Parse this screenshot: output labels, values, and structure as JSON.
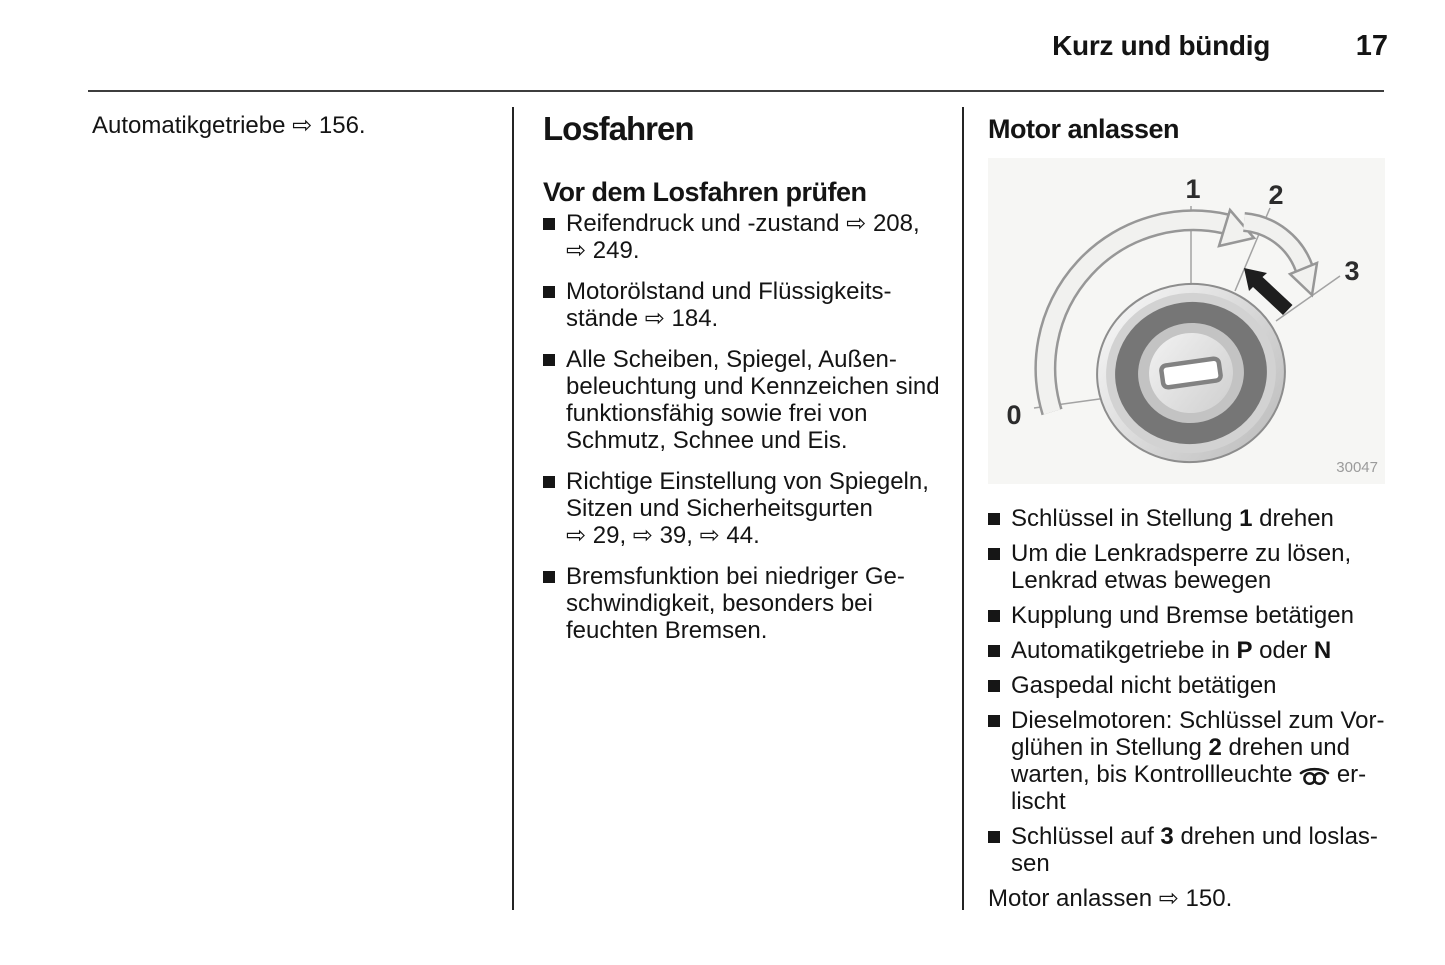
{
  "header": {
    "title": "Kurz und bündig",
    "page_number": "17"
  },
  "left_column": {
    "cross_reference": [
      {
        "text": "Automatikgetriebe ⇨ 156."
      }
    ]
  },
  "middle_column": {
    "heading": "Losfahren",
    "subheading": "Vor dem Losfahren prüfen",
    "bullets": [
      [
        {
          "text": "Reifendruck und -zustand ⇨ 208,"
        },
        {
          "br": true
        },
        {
          "text": "⇨ 249."
        }
      ],
      [
        {
          "text": "Motorölstand und Flüssigkeits-"
        },
        {
          "br": true
        },
        {
          "text": "stände ⇨ 184."
        }
      ],
      [
        {
          "text": "Alle Scheiben, Spiegel, Außen-"
        },
        {
          "br": true
        },
        {
          "text": "beleuchtung und Kennzeichen sind"
        },
        {
          "br": true
        },
        {
          "text": "funktionsfähig sowie frei von"
        },
        {
          "br": true
        },
        {
          "text": "Schmutz, Schnee und Eis."
        }
      ],
      [
        {
          "text": "Richtige Einstellung von Spiegeln,"
        },
        {
          "br": true
        },
        {
          "text": "Sitzen und Sicherheitsgurten"
        },
        {
          "br": true
        },
        {
          "text": "⇨ 29, ⇨ 39, ⇨ 44."
        }
      ],
      [
        {
          "text": "Bremsfunktion bei niedriger Ge-"
        },
        {
          "br": true
        },
        {
          "text": "schwindigkeit, besonders bei"
        },
        {
          "br": true
        },
        {
          "text": "feuchten Bremsen."
        }
      ]
    ]
  },
  "right_column": {
    "heading": "Motor anlassen",
    "figure": {
      "description": "ignition-switch-key-positions-diagram",
      "labels": {
        "pos_0": "0",
        "pos_1": "1",
        "pos_2": "2",
        "pos_3": "3"
      },
      "image_number": "30047"
    },
    "bullets": [
      [
        {
          "text": "Schlüssel in Stellung "
        },
        {
          "text": "1",
          "bold": true
        },
        {
          "text": " drehen"
        }
      ],
      [
        {
          "text": "Um die Lenkradsperre zu lösen,"
        },
        {
          "br": true
        },
        {
          "text": "Lenkrad etwas bewegen"
        }
      ],
      [
        {
          "text": "Kupplung und Bremse betätigen"
        }
      ],
      [
        {
          "text": "Automatikgetriebe in "
        },
        {
          "text": "P",
          "bold": true
        },
        {
          "text": " oder "
        },
        {
          "text": "N",
          "bold": true
        }
      ],
      [
        {
          "text": "Gaspedal nicht betätigen"
        }
      ],
      [
        {
          "text": "Dieselmotoren: Schlüssel zum Vor-"
        },
        {
          "br": true
        },
        {
          "text": "glühen in Stellung "
        },
        {
          "text": "2",
          "bold": true
        },
        {
          "text": " drehen und"
        },
        {
          "br": true
        },
        {
          "text": "warten, bis Kontrollleuchte "
        },
        {
          "icon": "glow-plug"
        },
        {
          "text": " er-"
        },
        {
          "br": true
        },
        {
          "text": "lischt"
        }
      ],
      [
        {
          "text": "Schlüssel auf "
        },
        {
          "text": "3",
          "bold": true
        },
        {
          "text": " drehen und loslas-"
        },
        {
          "br": true
        },
        {
          "text": "sen"
        }
      ]
    ],
    "cross_reference": [
      {
        "text": "Motor anlassen ⇨ 150."
      }
    ]
  },
  "icons": {
    "reference_arrow": "⇨",
    "glow_plug": "glow-plug-indicator-icon",
    "bullet": "black-square"
  }
}
